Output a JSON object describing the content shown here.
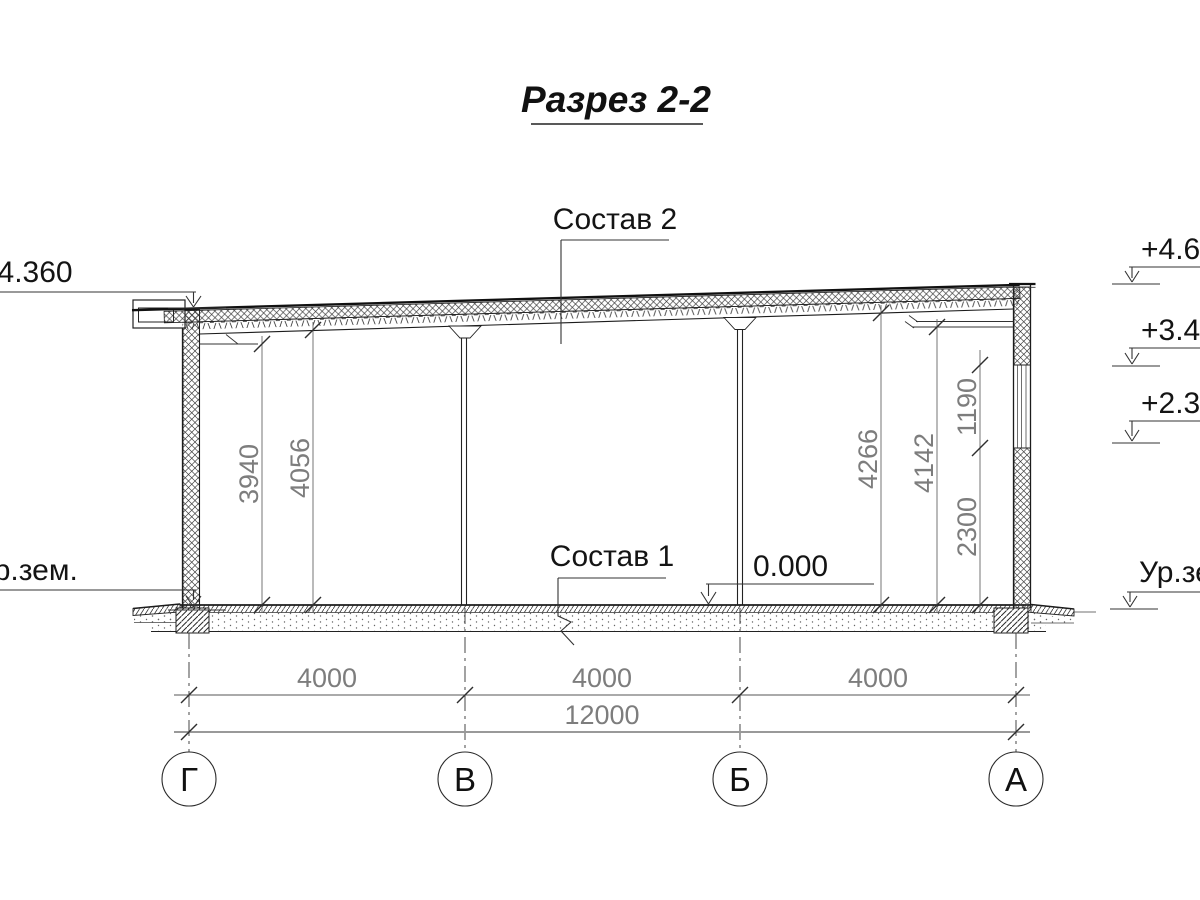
{
  "title": "Разрез 2-2",
  "callouts": {
    "roof_composition": "Состав 2",
    "floor_composition": "Состав 1",
    "zero_level": "0.000"
  },
  "elevations": {
    "left_roof": "+4.360",
    "right_top": "+4.68",
    "right_mid": "+3.49",
    "right_low": "+2.30",
    "ground_left": "Ур.зем.",
    "ground_right": "Ур.зем"
  },
  "dimensions": {
    "left_inner_1": "3940",
    "left_inner_2": "4056",
    "right_inner_1": "4266",
    "right_inner_2": "4142",
    "window_sill": "2300",
    "window_height": "1190",
    "span_1": "4000",
    "span_2": "4000",
    "span_3": "4000",
    "total": "12000"
  },
  "axes": {
    "a1": "Г",
    "a2": "В",
    "a3": "Б",
    "a4": "А"
  }
}
